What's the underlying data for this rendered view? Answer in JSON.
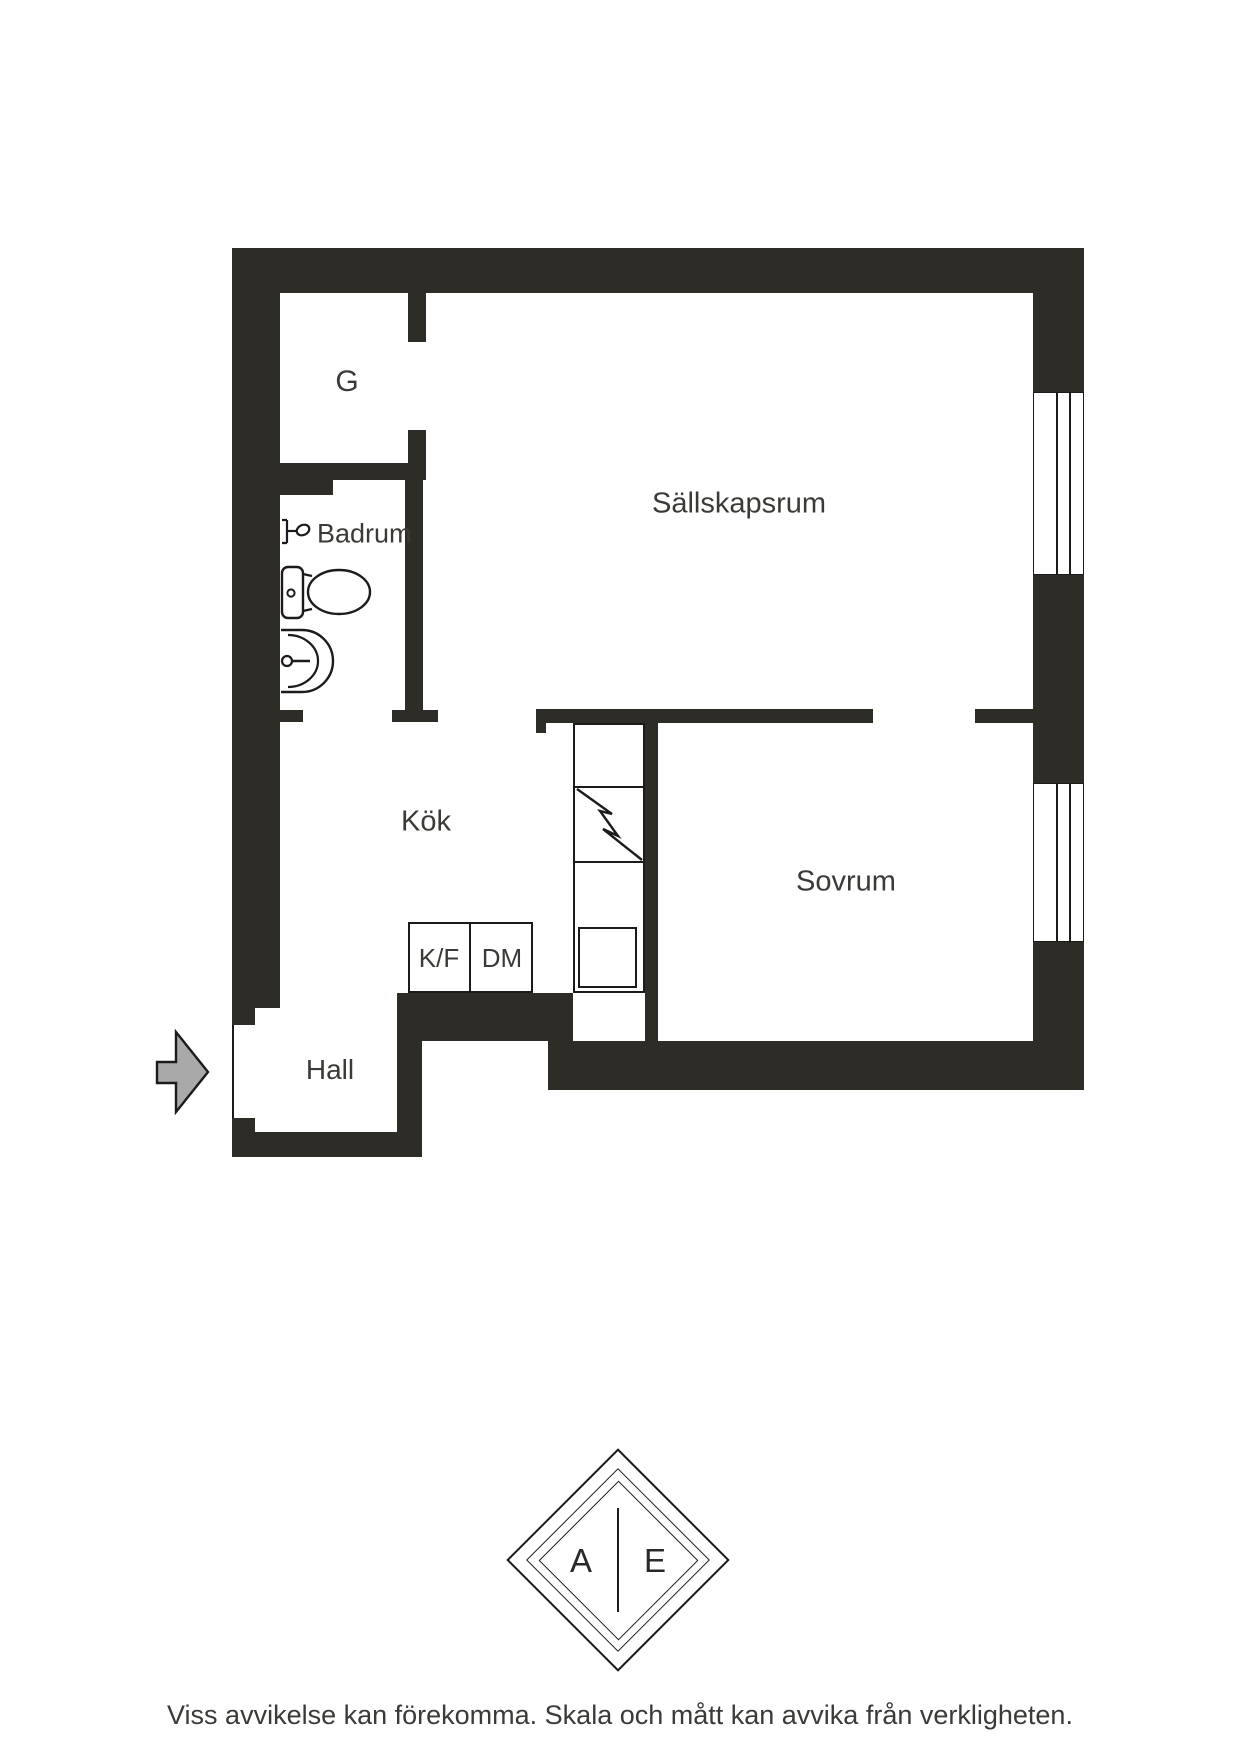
{
  "floorplan": {
    "rooms": {
      "g": {
        "label": "G"
      },
      "badrum": {
        "label": "Badrum"
      },
      "sallskapsrum": {
        "label": "Sällskapsrum"
      },
      "kok": {
        "label": "Kök"
      },
      "sovrum": {
        "label": "Sovrum"
      },
      "hall": {
        "label": "Hall"
      }
    },
    "appliances": {
      "fridge_freezer": {
        "label": "K/F"
      },
      "dishwasher": {
        "label": "DM"
      }
    },
    "icons": {
      "entrance": "entrance-arrow-icon",
      "toilet": "toilet-icon",
      "sink": "sink-icon",
      "shower": "shower-icon",
      "stove": "stove-lightning-icon",
      "windows": "window-icon"
    }
  },
  "logo": {
    "left_letter": "A",
    "right_letter": "E"
  },
  "footer": {
    "disclaimer": "Viss avvikelse kan förekomma. Skala och mått kan avvika från verkligheten."
  },
  "colors": {
    "wall": "#2e2c27",
    "line": "#1c1b19",
    "text": "#3b3a37",
    "arrow_fill": "#a9a9a9",
    "background": "#ffffff"
  }
}
